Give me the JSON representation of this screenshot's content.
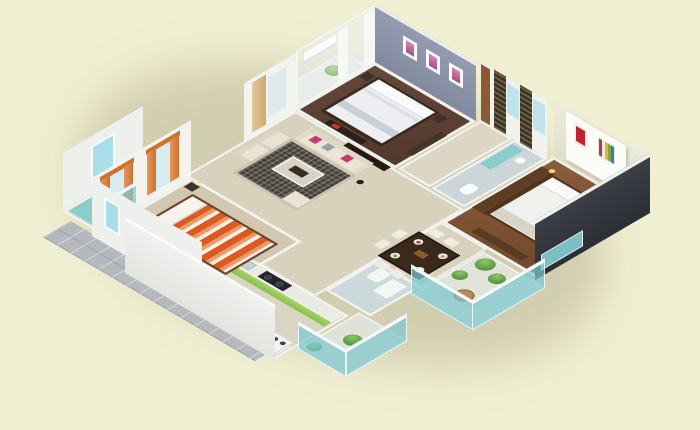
{
  "scene": {
    "type": "isometric-3d-floor-plan-render",
    "description": "3D cutaway isometric rendering of a three-bedroom apartment floor plan on a plain pale-cream background; no visible text or UI controls",
    "background_color": "#f1efd2",
    "has_text": false
  },
  "palette": {
    "background": "#f1efd2",
    "wall_white": "#f2f3f1",
    "accent_wall_blue_gray": "#8d94a8",
    "exterior_dark_charcoal": "#363a41",
    "floor_wood_dark": "#5a4233",
    "floor_wood_warm": "#7d5436",
    "floor_tile_beige": "#d8d2bd",
    "kitchen_cabinet_green": "#98c957",
    "glass_teal": "#8fd2d8",
    "curtain_orange": "#d4823f",
    "bed_stripe_orange": "#dc5a22",
    "cushion_magenta": "#c23d72",
    "terrace_tile_gray": "#b5b9be",
    "plant_green": "#57a23b",
    "curtain_tan": "#d9b98a",
    "wood_furniture": "#5f3e23"
  },
  "rooms": [
    {
      "id": "bedroom-middle",
      "name": "Bedroom (top, blue accent)",
      "floor": "dark walnut wood",
      "features": [
        "blue-gray accent wall with three pink framed artworks",
        "white double bed with dark wood frame",
        "two nightstands with lamps",
        "air-conditioner on glass wall",
        "white curtains",
        "small balcony with potted plant",
        "dresser",
        "foot bench with red books"
      ]
    },
    {
      "id": "bedroom-right",
      "name": "Bedroom (right)",
      "floor": "warm brown wood",
      "features": [
        "white headboard wall with red artwork and multicolor-stripe artwork",
        "wooden bed with white linens",
        "glowing bedside lamps",
        "tall wooden wardrobe",
        "low dresser",
        "dark charcoal exterior wall with teal window band"
      ]
    },
    {
      "id": "bedroom-left",
      "name": "Bedroom (left, orange)",
      "floor": "beige",
      "features": [
        "orange-and-white striped bed with wood frame",
        "two windows with orange curtains",
        "dark wood foot bench with red books",
        "nightstand with lamp"
      ]
    },
    {
      "id": "living-room",
      "name": "Living room",
      "floor": "beige tile",
      "features": [
        "cream three-seat sofa with magenta and gray cushions",
        "two cream armchairs",
        "dark patterned rug",
        "glass-top coffee table",
        "cream ottoman",
        "dark floor lamp",
        "dark TV cabinet",
        "window with tan curtain"
      ]
    },
    {
      "id": "dining",
      "name": "Dining area",
      "floor": "beige tile",
      "features": [
        "dark wood dining table",
        "six white chairs",
        "white plates with red, orange and green food",
        "wooden tray"
      ]
    },
    {
      "id": "kitchen",
      "name": "Kitchen",
      "floor": "beige tile",
      "features": [
        "green-fronted counter with black gas hob and steel sink",
        "second counter with jars",
        "white oven unit"
      ]
    },
    {
      "id": "utility",
      "name": "Utility nook",
      "features": [
        "white front-loading washing machine"
      ]
    },
    {
      "id": "bath-left",
      "name": "Bathroom (left)",
      "features": [
        "teal glass shower",
        "white WC",
        "white basin",
        "blue exterior window pane"
      ]
    },
    {
      "id": "bath-top",
      "name": "Bathroom (top block)",
      "features": [
        "teal glass shower band",
        "white WC",
        "round basin",
        "dark patterned wardrobe strips with blue panes on back wall",
        "brown entry door"
      ]
    },
    {
      "id": "bath-small",
      "name": "Bathroom (center-right)",
      "features": [
        "white tub",
        "white fixtures",
        "teal edge"
      ]
    },
    {
      "id": "balcony-se",
      "name": "Balcony (bottom right)",
      "features": [
        "three green potted plants",
        "round wooden table with two seats",
        "teal glass railing with white cap"
      ]
    },
    {
      "id": "balcony-mini",
      "name": "Service balcony (bottom center)",
      "features": [
        "two green plants",
        "teal glass railing"
      ]
    },
    {
      "id": "balcony-mid",
      "name": "Balcony (top, off middle bedroom)",
      "features": [
        "potted plant"
      ]
    },
    {
      "id": "terrace",
      "name": "Gray tiled apron (bottom-left edge)",
      "features": [
        "square gray tiles"
      ]
    }
  ],
  "projection": {
    "style": "isometric",
    "plan_to_screen_matrix": [
      0.53,
      0.31,
      -0.53,
      0.31
    ],
    "wall_skew_deg": 30.3
  }
}
